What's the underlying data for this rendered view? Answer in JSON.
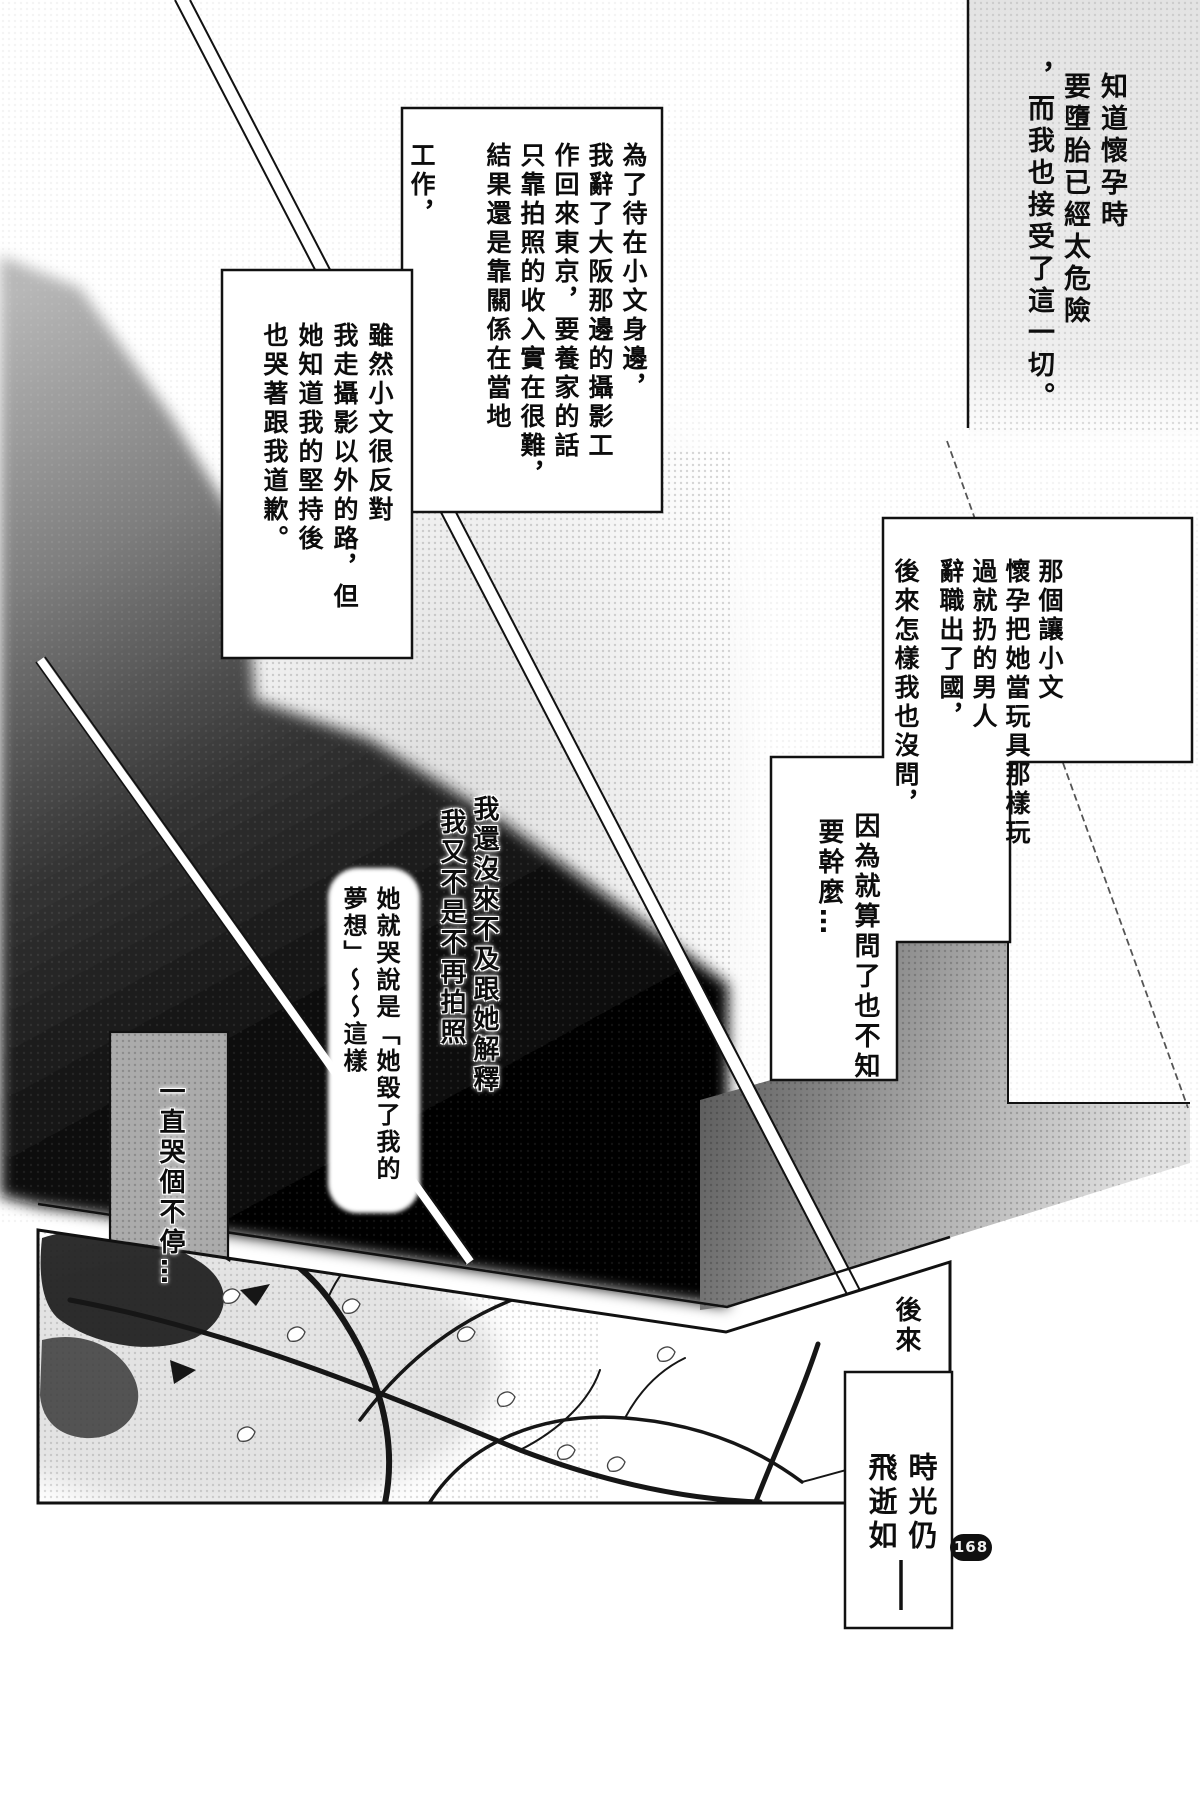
{
  "page": {
    "number_badge": "168"
  },
  "colors": {
    "ink": "#111111",
    "paper": "#ffffff",
    "tone_dark": "#000000",
    "tone_gray": "#9a9a9a"
  },
  "blocks": {
    "narration_top_right": {
      "cols": [
        "知道懷孕時",
        "要墮胎已經太危險",
        "，而我也接受了這一切。"
      ]
    },
    "narration_work": {
      "cols": [
        "為了待在小文身邊，",
        "我辭了大阪那邊的攝影工",
        "作回來東京，要養家的話",
        "只靠拍照的收入實在很難，",
        "結果還是靠關係在當地",
        "工作，"
      ]
    },
    "narration_oppose": {
      "cols": [
        "雖然小文很反對",
        "我走攝影以外的路，但",
        "她知道我的堅持後",
        "也哭著跟我道歉。"
      ]
    },
    "narration_man": {
      "cols": [
        "那個讓小文",
        "懷孕把她當玩具那樣玩",
        "過就扔的男人",
        "辭職出了國，",
        "後來怎樣我也沒問，"
      ]
    },
    "narration_why": {
      "cols": [
        "因為就算問了也不知",
        "要幹麼…"
      ]
    },
    "narration_explain": {
      "cols": [
        "我還沒來不及跟她解釋",
        "我又不是不再拍照"
      ]
    },
    "speech_cry": {
      "cols": [
        "她就哭說是「她毀了我的",
        "夢想」～～這樣"
      ]
    },
    "narration_crying": {
      "cols": [
        "一直哭個不停…"
      ]
    },
    "caption_later": {
      "cols": [
        "後來"
      ]
    },
    "caption_time": {
      "cols": [
        "時光仍",
        "飛逝如"
      ]
    }
  }
}
